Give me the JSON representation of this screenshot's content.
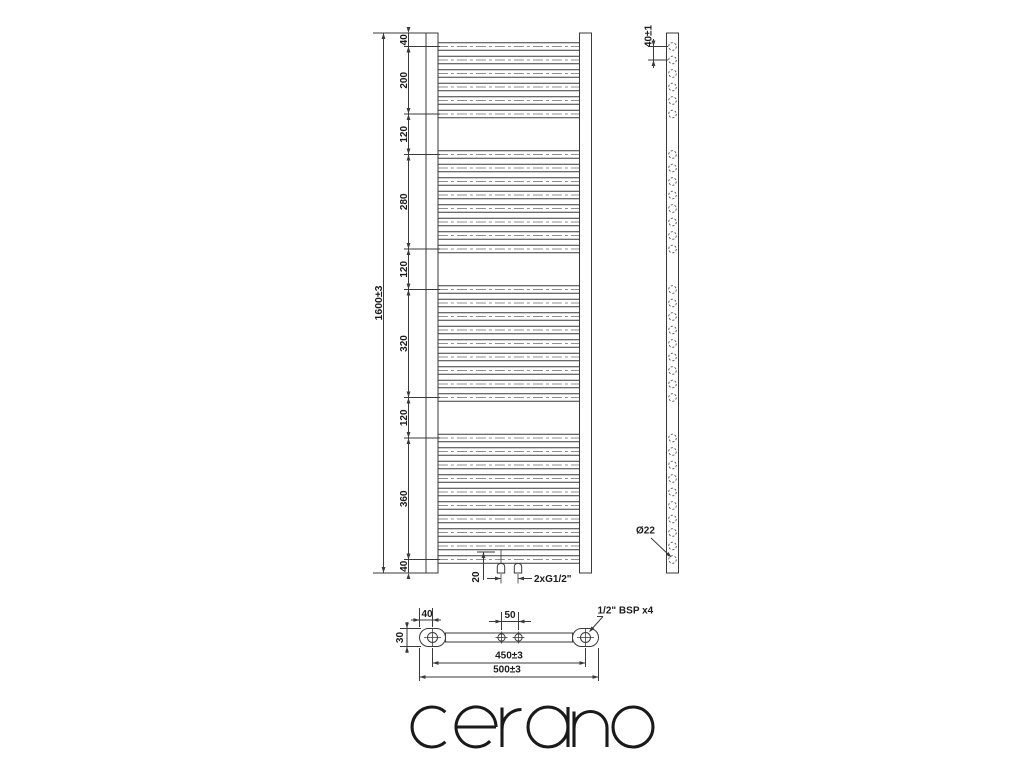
{
  "views": {
    "front": {
      "overall_height": "1600±3",
      "segments": [
        "40",
        "200",
        "120",
        "280",
        "120",
        "320",
        "120",
        "360",
        "40"
      ],
      "rung_groups": [
        6,
        8,
        9,
        10
      ],
      "rung_pitch_mm": 40,
      "connection_offset": "20",
      "connection_thread": "2xG1/2\""
    },
    "side": {
      "pitch_label": "40±1",
      "tube_diameter_label": "Ø22"
    },
    "bottom": {
      "edge_to_axis": "40",
      "valve_spacing": "50",
      "depth": "30",
      "axis_distance": "450±3",
      "overall_width": "500±3",
      "thread_note": "1/2\" BSP x4"
    }
  },
  "brand": {
    "logo": "cerano"
  },
  "colors": {
    "line": "#3a3a3a",
    "text": "#1c1c1c",
    "centerline": "#8f8f8f",
    "logo": "#1a1a1a",
    "background": "#ffffff"
  }
}
